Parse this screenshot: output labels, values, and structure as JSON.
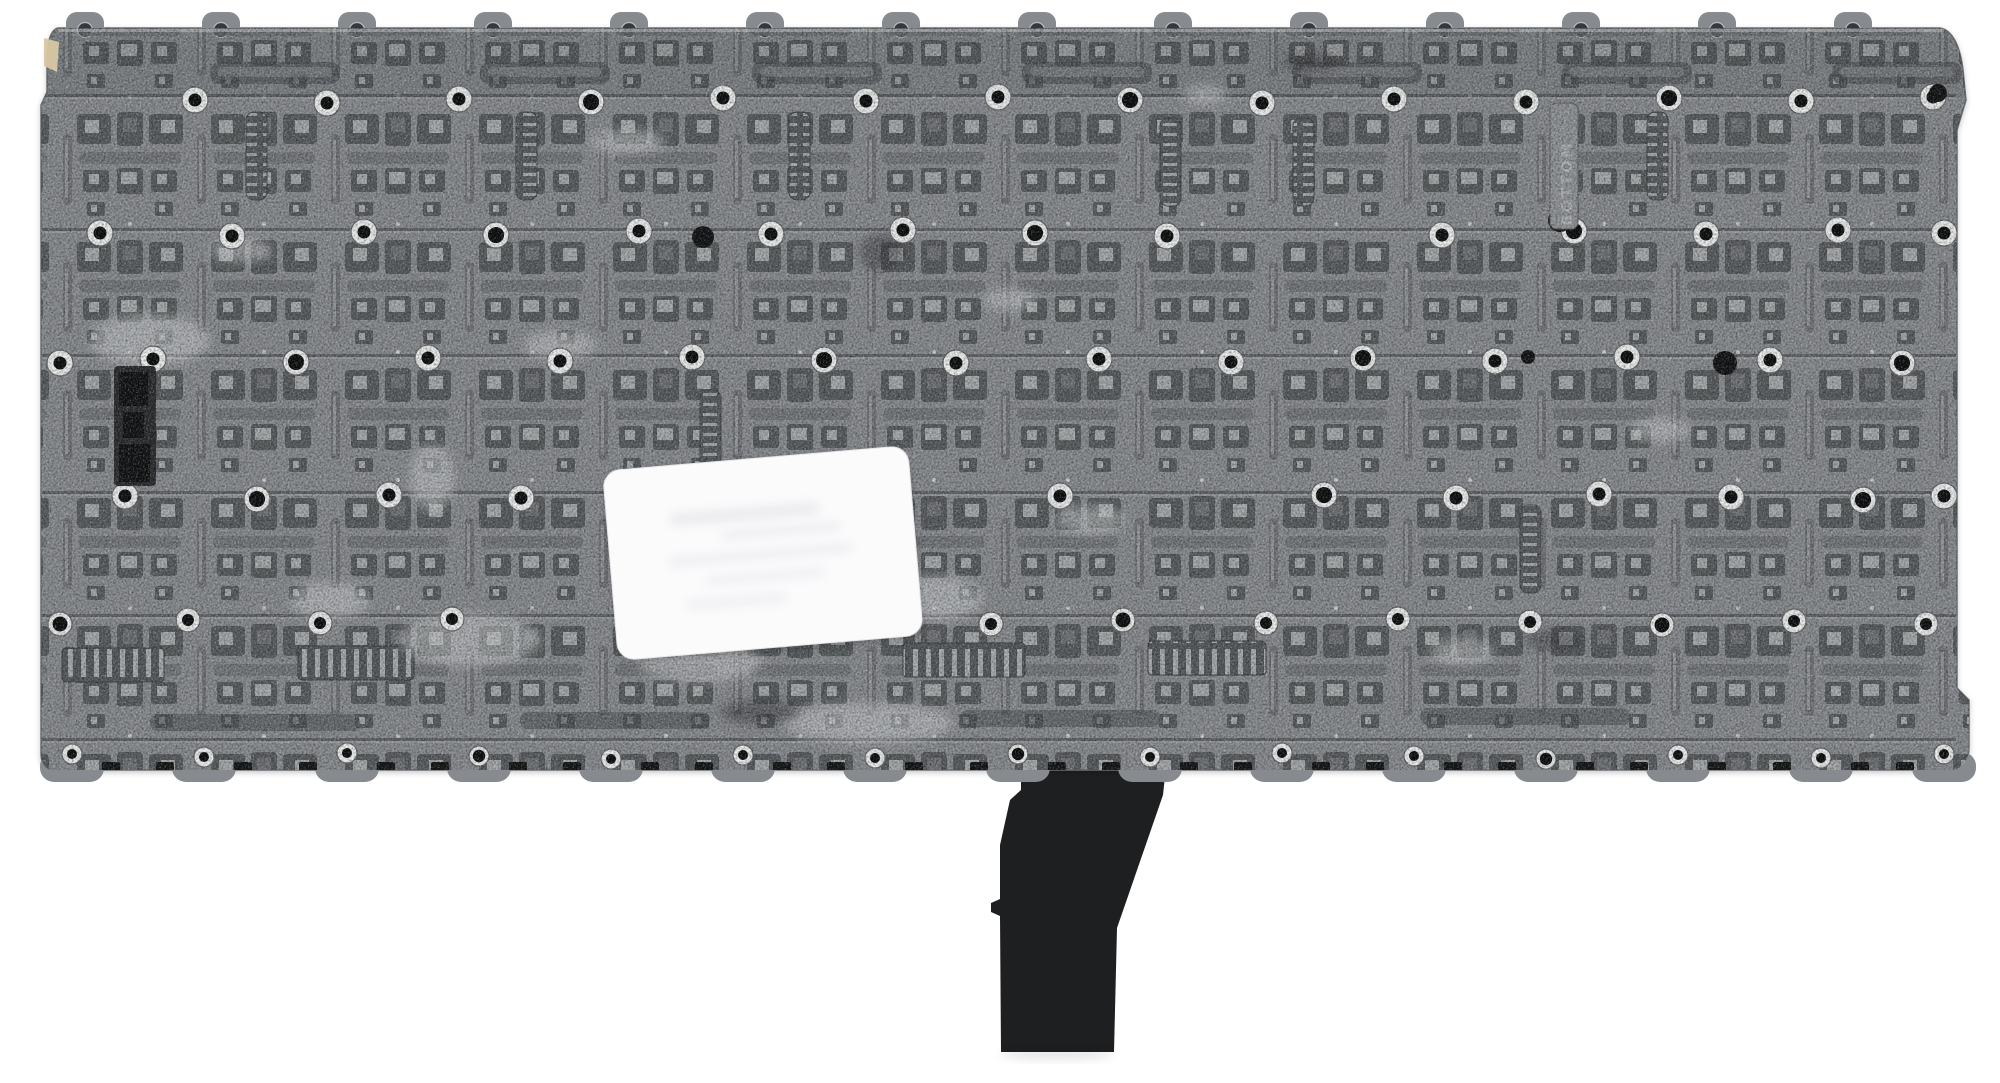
{
  "scene": {
    "title": "Laptop keyboard backplate, rear view",
    "object": "keyboard-replacement-part-back-side",
    "background": "white seamless backdrop"
  },
  "markings": {
    "vertical_text": "BOTTOM"
  },
  "parts": {
    "plate": "gray metal backplate with repeating key-mechanism cutouts and screw bosses",
    "sticker": "white rounded label, slightly tilted, faint illegible print",
    "cable": "black ribbon cable hanging from bottom center",
    "connector": "small black connector block near left edge",
    "tape_fragment": "tan tape fragment at upper-left edge"
  },
  "colors": {
    "background": "#ffffff",
    "plate_base": "#878a8e",
    "plate_dark": "#54585b",
    "plate_mid": "#6e7175",
    "plate_light": "#a7aaad",
    "plate_bright": "#c8cacc",
    "screw_ring": "#eaeceb",
    "screw_hole": "#0d0e0f",
    "black_dot": "#121314",
    "cable": "#1e1f21",
    "sticker": "#fbfbfc",
    "tape_fragment": "#d8c7a4",
    "emboss_text": "#b4b7ba"
  }
}
